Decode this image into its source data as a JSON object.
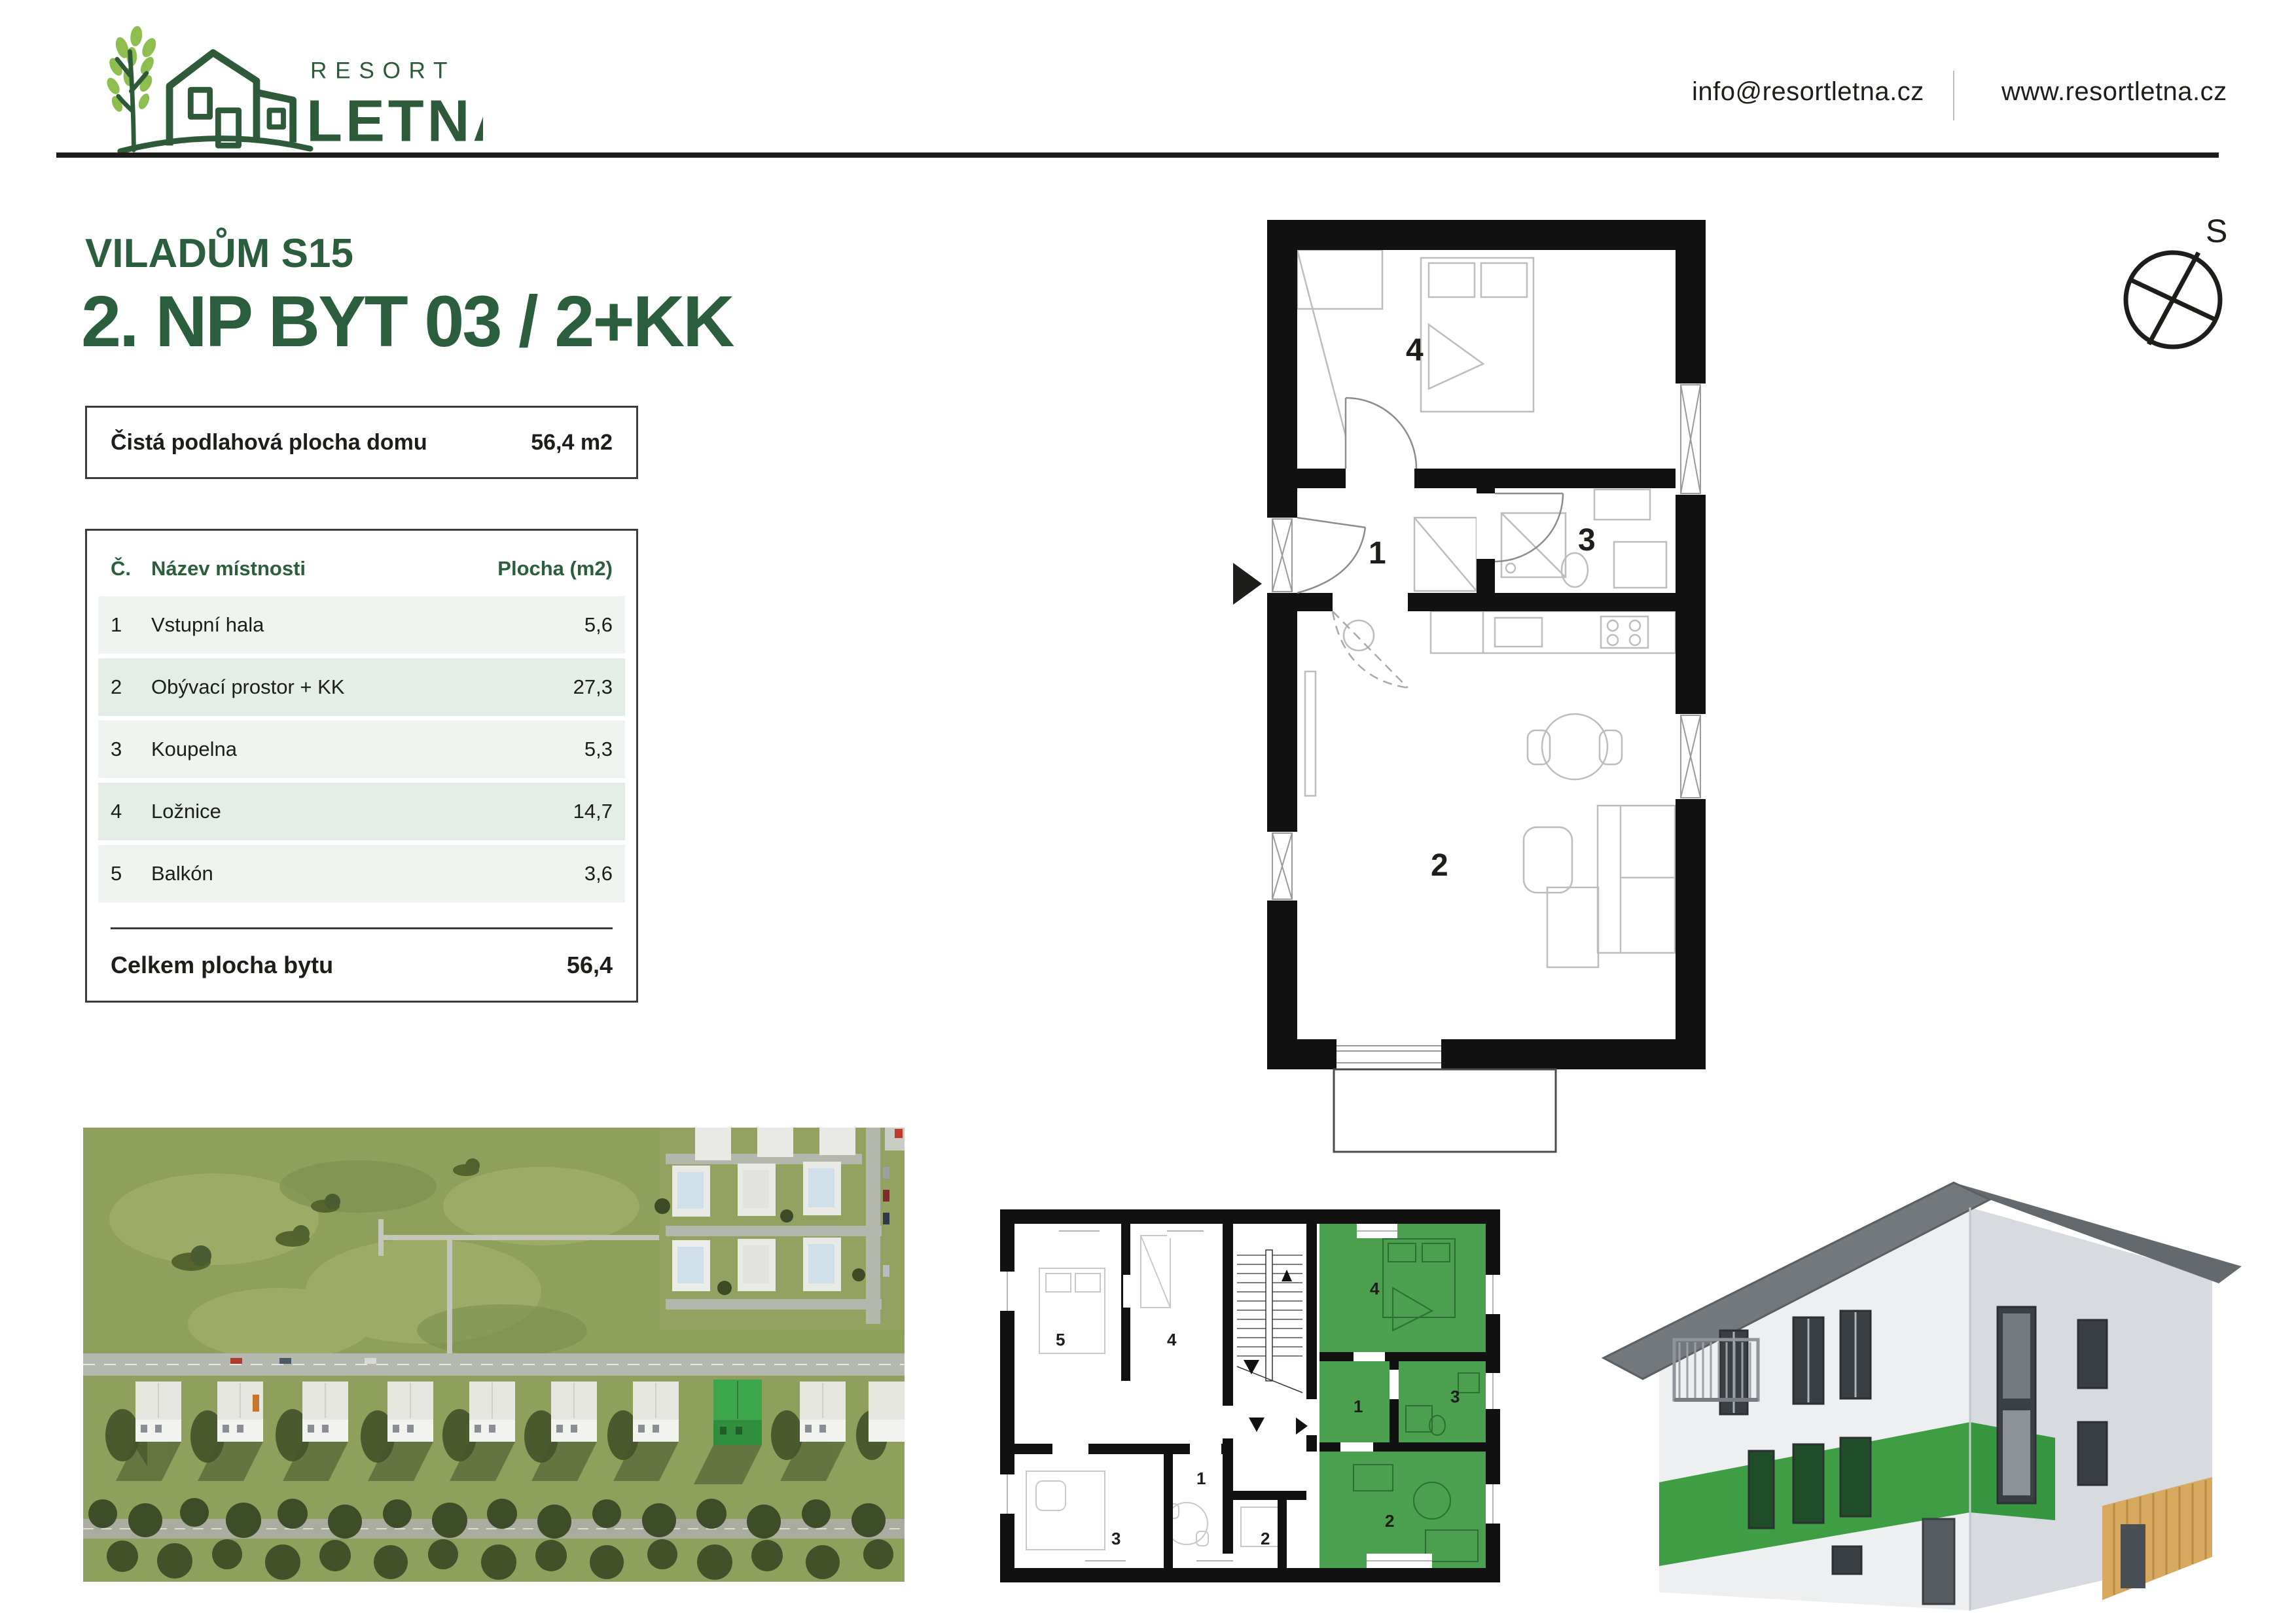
{
  "header": {
    "brand_top": "RESORT",
    "brand_bottom": "LETNÁ",
    "email": "info@resortletna.cz",
    "website": "www.resortletna.cz"
  },
  "title": {
    "subtitle": "VILADŮM S15",
    "main": "2. NP BYT 03 / 2+KK"
  },
  "area_box": {
    "label": "Čistá podlahová plocha domu",
    "value": "56,4 m2"
  },
  "room_table": {
    "headers": {
      "number": "Č.",
      "name": "Název místnosti",
      "area": "Plocha (m2)"
    },
    "rows": [
      {
        "number": "1",
        "name": "Vstupní hala",
        "area": "5,6"
      },
      {
        "number": "2",
        "name": "Obývací prostor + KK",
        "area": "27,3"
      },
      {
        "number": "3",
        "name": "Koupelna",
        "area": "5,3"
      },
      {
        "number": "4",
        "name": "Ložnice",
        "area": "14,7"
      },
      {
        "number": "5",
        "name": "Balkón",
        "area": "3,6"
      }
    ],
    "footer": {
      "label": "Celkem plocha bytu",
      "value": "56,4"
    }
  },
  "compass": {
    "label": "S"
  },
  "main_plan": {
    "labels": {
      "room1": "1",
      "room2": "2",
      "room3": "3",
      "room4": "4"
    }
  },
  "floor_overview": {
    "left_labels": {
      "room1": "1",
      "room2": "2",
      "room3": "3",
      "room4": "4",
      "room5": "5"
    },
    "right_labels": {
      "room1": "1",
      "room2": "2",
      "room3": "3",
      "room4": "4"
    }
  },
  "colors": {
    "brand_dark_green": "#2b5e3c",
    "leaf_green": "#8fbe50",
    "highlight_green": "#4aa04e",
    "band_green": "#3f9e44",
    "row_light": "#eff4f0",
    "row_dark": "#e4eee6",
    "ink": "#1d1d1b"
  }
}
